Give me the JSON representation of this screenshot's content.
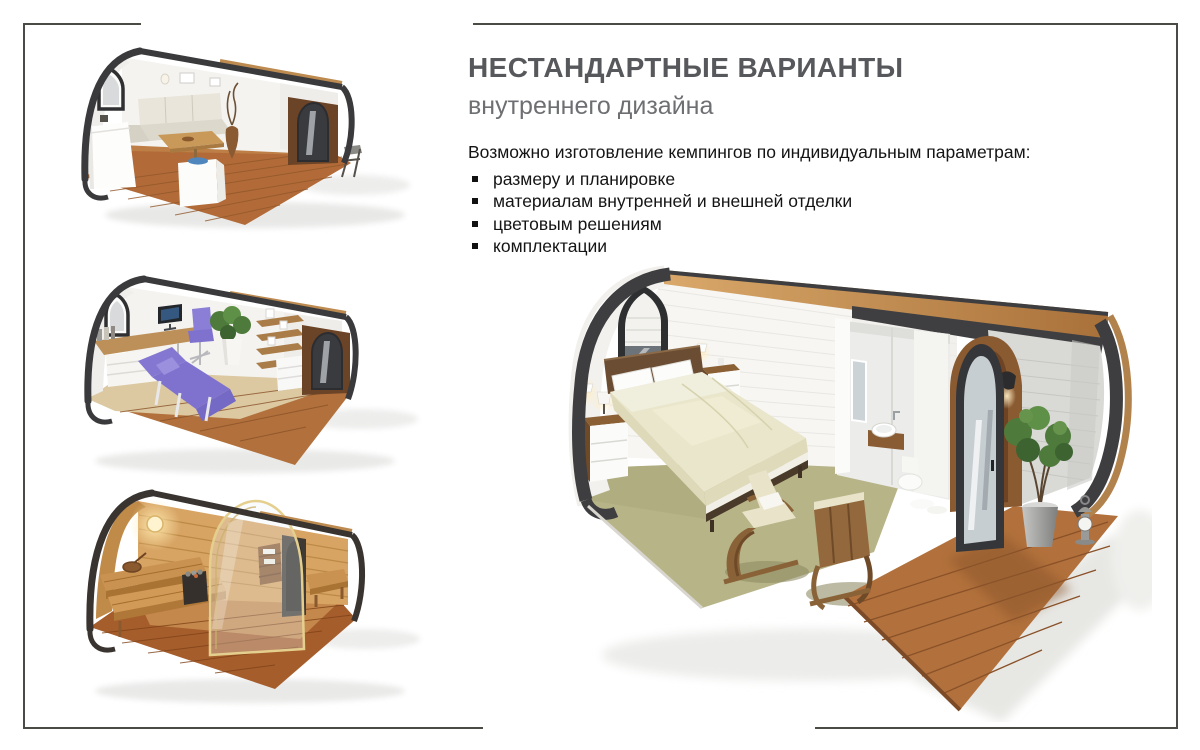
{
  "slide": {
    "background": "#ffffff",
    "frame_color": "#4b4b46"
  },
  "header": {
    "title": "НЕСТАНДАРТНЫЕ ВАРИАНТЫ",
    "subtitle": "внутреннего дизайна",
    "title_color": "#57585b",
    "subtitle_color": "#6e6f72"
  },
  "content": {
    "intro": "Возможно изготовление кемпингов по индивидуальным параметрам:",
    "bullets": [
      "размеру и планировке",
      "материалам внутренней и внешней отделки",
      "цветовым решениям",
      "комплектации"
    ],
    "text_color": "#141414"
  },
  "figures": [
    {
      "name": "pod-living-dining"
    },
    {
      "name": "pod-office-massage"
    },
    {
      "name": "pod-sauna"
    },
    {
      "name": "pod-bedroom-bathroom"
    }
  ],
  "palette": {
    "shell_dark": "#3e3e40",
    "roof_wood": "#c08b52",
    "deck_wood": "#b2713c",
    "interior_wall": "#f5f4f1",
    "carpet_olive": "#b7b488",
    "bedding_cream": "#e9e6cb",
    "accent_purple": "#7f72cf",
    "sauna_wood": "#d7a464",
    "plant_green": "#4e7a3b"
  }
}
